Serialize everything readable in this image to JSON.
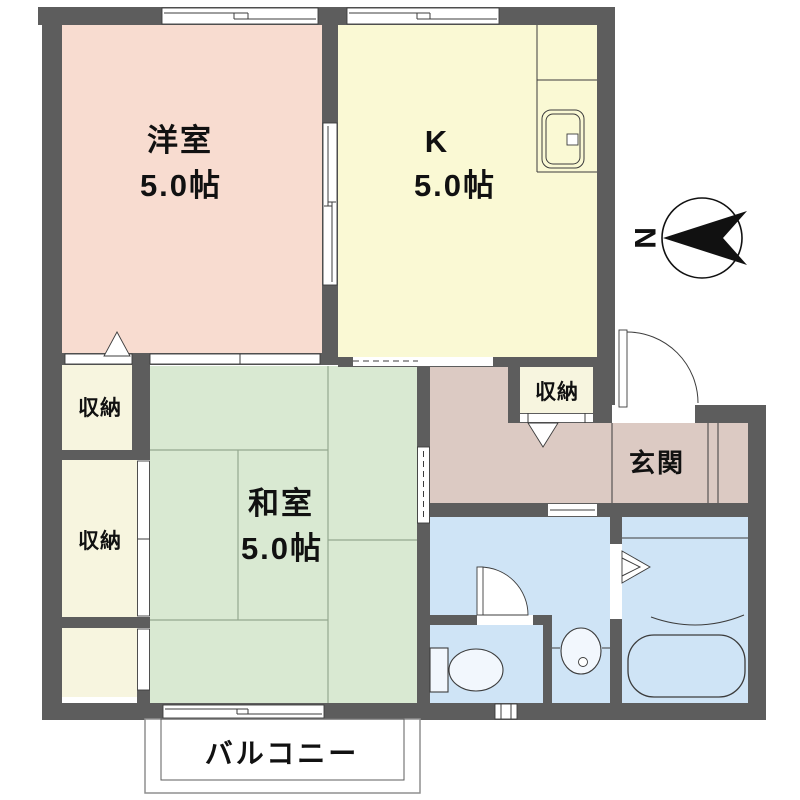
{
  "palette": {
    "wall": "#5d5d5d",
    "western": "#f8dcd0",
    "kitchen": "#faf9d4",
    "tatami": "#d9e9d2",
    "tatami_line": "#94a88f",
    "closet": "#f7f5df",
    "hall": "#dccac3",
    "wet": "#cfe4f6",
    "fixture": "#f2f7fd",
    "line": "#3c3c3c",
    "ink": "#111111"
  },
  "compass": {
    "north_label": "N"
  },
  "rooms": {
    "western": {
      "name": "洋室",
      "area": "5.0帖"
    },
    "kitchen": {
      "name": "K",
      "area": "5.0帖"
    },
    "japanese": {
      "name": "和室",
      "area": "5.0帖"
    },
    "closet_upper": {
      "name": "収納"
    },
    "closet_lower": {
      "name": "収納"
    },
    "hall_closet": {
      "name": "収納"
    },
    "entrance": {
      "name": "玄関"
    },
    "balcony": {
      "name": "バルコニー"
    }
  }
}
